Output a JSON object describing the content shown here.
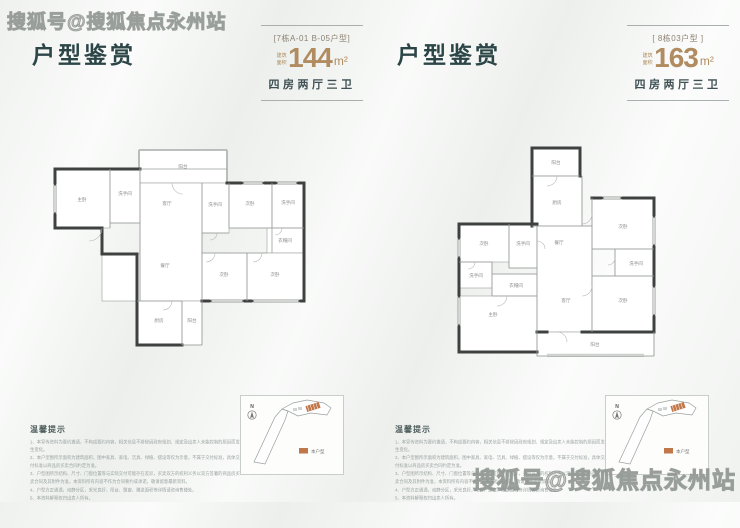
{
  "watermark": "搜狐号@搜狐焦点永州站",
  "panels": [
    {
      "title": "户型鉴赏",
      "unit_label": "[7栋A-01 B-05户型]",
      "area_prefix": "建筑面积",
      "area_value": "144",
      "area_unit": "m²",
      "layout_text": "四房两厅三卫",
      "rooms": [
        "阳台",
        "主卧",
        "洗手间",
        "客厅",
        "洗手间",
        "次卧",
        "洗手间",
        "衣帽间",
        "餐厅",
        "次卧",
        "次卧",
        "厨房",
        "阳台"
      ]
    },
    {
      "title": "户型鉴赏",
      "unit_label": "[ 8栋03户型 ]",
      "area_prefix": "建筑面积",
      "area_value": "163",
      "area_unit": "m²",
      "layout_text": "四房两厅三卫",
      "rooms": [
        "阳台",
        "厨房",
        "次卧",
        "次卧",
        "洗手间",
        "餐厅",
        "洗手间",
        "洗手间",
        "衣帽间",
        "客厅",
        "次卧",
        "主卧",
        "阳台"
      ]
    }
  ],
  "notes": {
    "heading": "温馨提示",
    "lines": [
      "1、本宣传资料为要约邀请，不构成要约内容，相关信息不排除因政府规划、规定及出卖人未能控制的原因而发生变化。",
      "2、本户型图所示面积为建筑面积，图中家具、家电、洁具、绿植、摆设等仅为示意，不属于交付标准，具体交付标准以商品房买卖合同约定为准。",
      "3、户型图所示结构、尺寸、门窗位置等与实际交付可能存在差异，买卖双方的权利义务以双方签署的商品房买卖合同及其附件为准，本资料所有内容不作为合同要约或承诺，敬请留意最新资料。",
      "4、户型方正通透，动静分区，采光良好，阳台、飘窗、赠送面积等详情请咨询售楼处。",
      "5、本资料解释权归出卖人所有。"
    ]
  },
  "sitemap": {
    "north_label": "N",
    "legend_label": "本户型",
    "accent_color": "#c0774a"
  }
}
